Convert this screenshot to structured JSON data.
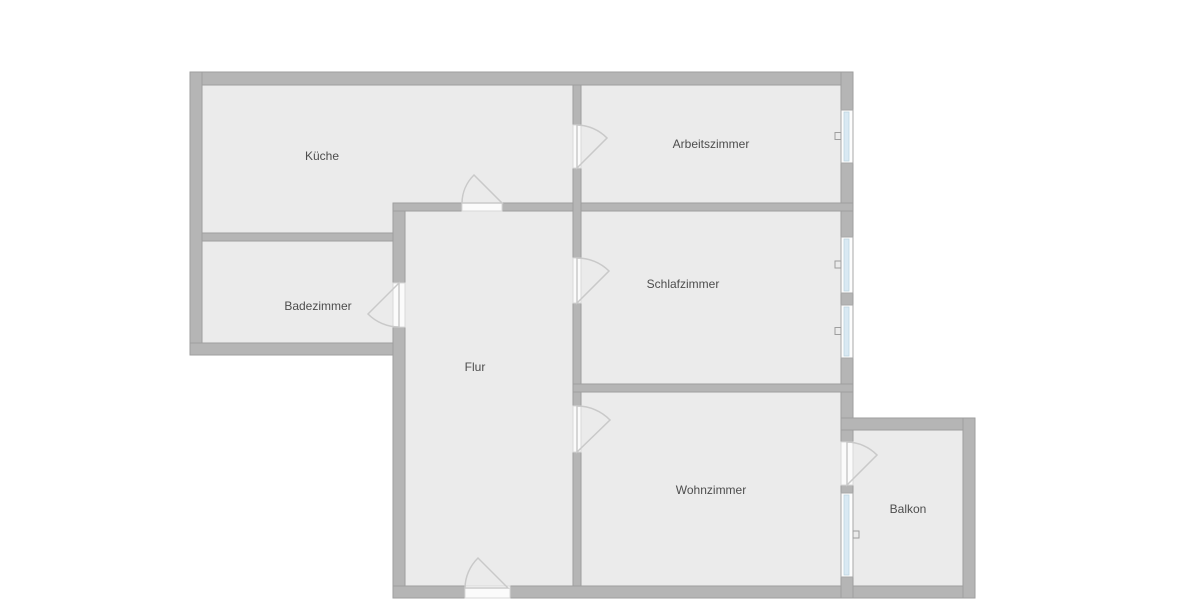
{
  "canvas": {
    "width": 1200,
    "height": 600,
    "background": "#ffffff"
  },
  "palette": {
    "wall_fill": "#b5b5b5",
    "wall_edge": "#9e9e9e",
    "wall_highlight": "#cfcfcf",
    "floor_fill": "#ebebeb",
    "door_sill_fill": "#fbfbfb",
    "door_sill_edge": "#d8d8d8",
    "door_arc_stroke": "#c9c9c9",
    "window_frame_fill": "#fdfdfd",
    "window_frame_edge": "#a8a8a8",
    "window_glass_fill": "#d9e9f3",
    "window_glass_edge": "#bcd3e0",
    "window_handle_stroke": "#9e9e9e",
    "label_color": "#4d4d4d"
  },
  "rooms": [
    {
      "id": "kueche",
      "label": "Küche",
      "floor": {
        "x": 202,
        "y": 85,
        "w": 371,
        "h": 148
      },
      "label_pos": {
        "x": 322,
        "y": 156
      }
    },
    {
      "id": "arbeitszimmer",
      "label": "Arbeitszimmer",
      "floor": {
        "x": 581,
        "y": 85,
        "w": 260,
        "h": 118
      },
      "label_pos": {
        "x": 711,
        "y": 144
      }
    },
    {
      "id": "badezimmer",
      "label": "Badezimmer",
      "floor": {
        "x": 202,
        "y": 241,
        "w": 191,
        "h": 102
      },
      "label_pos": {
        "x": 318,
        "y": 306
      }
    },
    {
      "id": "flur",
      "label": "Flur",
      "floor": {
        "x": 405,
        "y": 211,
        "w": 168,
        "h": 375
      },
      "label_pos": {
        "x": 475,
        "y": 367
      }
    },
    {
      "id": "schlafzimmer",
      "label": "Schlafzimmer",
      "floor": {
        "x": 581,
        "y": 211,
        "w": 260,
        "h": 173
      },
      "label_pos": {
        "x": 683,
        "y": 284
      }
    },
    {
      "id": "wohnzimmer",
      "label": "Wohnzimmer",
      "floor": {
        "x": 581,
        "y": 392,
        "w": 260,
        "h": 194
      },
      "label_pos": {
        "x": 711,
        "y": 490
      }
    },
    {
      "id": "balkon",
      "label": "Balkon",
      "floor": {
        "x": 853,
        "y": 430,
        "w": 110,
        "h": 156
      },
      "label_pos": {
        "x": 908,
        "y": 509
      }
    }
  ],
  "walls": [
    {
      "name": "wall-exterior-top",
      "x": 190,
      "y": 72,
      "w": 663,
      "h": 13
    },
    {
      "name": "wall-exterior-left",
      "x": 190,
      "y": 72,
      "w": 12,
      "h": 283
    },
    {
      "name": "wall-exterior-bath-bottom",
      "x": 190,
      "y": 343,
      "w": 215,
      "h": 12
    },
    {
      "name": "wall-hall-left",
      "x": 393,
      "y": 203,
      "w": 12,
      "h": 395
    },
    {
      "name": "wall-exterior-bottom",
      "x": 393,
      "y": 586,
      "w": 582,
      "h": 12
    },
    {
      "name": "wall-exterior-right-1",
      "x": 841,
      "y": 72,
      "w": 12,
      "h": 38
    },
    {
      "name": "wall-exterior-right-2",
      "x": 841,
      "y": 163,
      "w": 12,
      "h": 74
    },
    {
      "name": "wall-exterior-right-3",
      "x": 841,
      "y": 293,
      "w": 12,
      "h": 12
    },
    {
      "name": "wall-exterior-right-4",
      "x": 841,
      "y": 358,
      "w": 12,
      "h": 84
    },
    {
      "name": "wall-balcony-divider-1",
      "x": 841,
      "y": 485,
      "w": 12,
      "h": 8
    },
    {
      "name": "wall-balcony-divider-2",
      "x": 841,
      "y": 577,
      "w": 12,
      "h": 21
    },
    {
      "name": "wall-balcony-top",
      "x": 841,
      "y": 418,
      "w": 134,
      "h": 12
    },
    {
      "name": "wall-balcony-right",
      "x": 963,
      "y": 418,
      "w": 12,
      "h": 180
    },
    {
      "name": "wall-hall-top-left",
      "x": 393,
      "y": 203,
      "w": 69,
      "h": 8
    },
    {
      "name": "wall-hall-top-right",
      "x": 502,
      "y": 203,
      "w": 351,
      "h": 8
    },
    {
      "name": "wall-vertical-divider-1",
      "x": 573,
      "y": 85,
      "w": 8,
      "h": 40
    },
    {
      "name": "wall-vertical-divider-2",
      "x": 573,
      "y": 168,
      "w": 8,
      "h": 90
    },
    {
      "name": "wall-vertical-divider-3",
      "x": 573,
      "y": 303,
      "w": 8,
      "h": 103
    },
    {
      "name": "wall-vertical-divider-4",
      "x": 573,
      "y": 452,
      "w": 8,
      "h": 134
    },
    {
      "name": "wall-bath-top",
      "x": 202,
      "y": 233,
      "w": 191,
      "h": 8
    },
    {
      "name": "wall-bedroom-living-divider",
      "x": 573,
      "y": 384,
      "w": 280,
      "h": 8
    }
  ],
  "doors": [
    {
      "name": "door-kueche",
      "sill": {
        "x": 462,
        "y": 203,
        "w": 40,
        "h": 8
      },
      "hinge": [
        502,
        203
      ],
      "start": [
        462,
        203
      ],
      "tip": [
        474,
        175
      ],
      "r": 40
    },
    {
      "name": "door-arbeitszimmer",
      "sill": {
        "x": 573,
        "y": 125,
        "w": 8,
        "h": 43
      },
      "hinge": [
        577,
        168
      ],
      "start": [
        577,
        125
      ],
      "tip": [
        607,
        138
      ],
      "r": 43
    },
    {
      "name": "door-schlafzimmer",
      "sill": {
        "x": 573,
        "y": 258,
        "w": 8,
        "h": 45
      },
      "hinge": [
        577,
        303
      ],
      "start": [
        577,
        258
      ],
      "tip": [
        609,
        271
      ],
      "r": 45
    },
    {
      "name": "door-wohnzimmer",
      "sill": {
        "x": 573,
        "y": 406,
        "w": 8,
        "h": 46
      },
      "hinge": [
        577,
        452
      ],
      "start": [
        577,
        406
      ],
      "tip": [
        610,
        420
      ],
      "r": 46
    },
    {
      "name": "door-badezimmer",
      "sill": {
        "x": 393,
        "y": 283,
        "w": 12,
        "h": 44
      },
      "hinge": [
        399,
        283
      ],
      "start": [
        399,
        327
      ],
      "tip": [
        368,
        314
      ],
      "r": 44
    },
    {
      "name": "door-balkon",
      "sill": {
        "x": 841,
        "y": 442,
        "w": 12,
        "h": 43
      },
      "hinge": [
        847,
        485
      ],
      "start": [
        847,
        442
      ],
      "tip": [
        877,
        455
      ],
      "r": 43
    },
    {
      "name": "door-entrance",
      "sill": {
        "x": 465,
        "y": 586,
        "w": 45,
        "h": 12
      },
      "hinge": [
        508,
        588
      ],
      "start": [
        465,
        588
      ],
      "tip": [
        478,
        558
      ],
      "r": 43
    }
  ],
  "windows": [
    {
      "name": "window-arbeitszimmer",
      "x": 841,
      "y": 110,
      "w": 12,
      "h": 53,
      "handle_side": "left"
    },
    {
      "name": "window-schlafzimmer-1",
      "x": 841,
      "y": 237,
      "w": 12,
      "h": 56,
      "handle_side": "left"
    },
    {
      "name": "window-schlafzimmer-2",
      "x": 841,
      "y": 305,
      "w": 12,
      "h": 53,
      "handle_side": "left"
    },
    {
      "name": "window-balkon",
      "x": 841,
      "y": 493,
      "w": 12,
      "h": 84,
      "handle_side": "right"
    }
  ],
  "label_font_size": 12
}
